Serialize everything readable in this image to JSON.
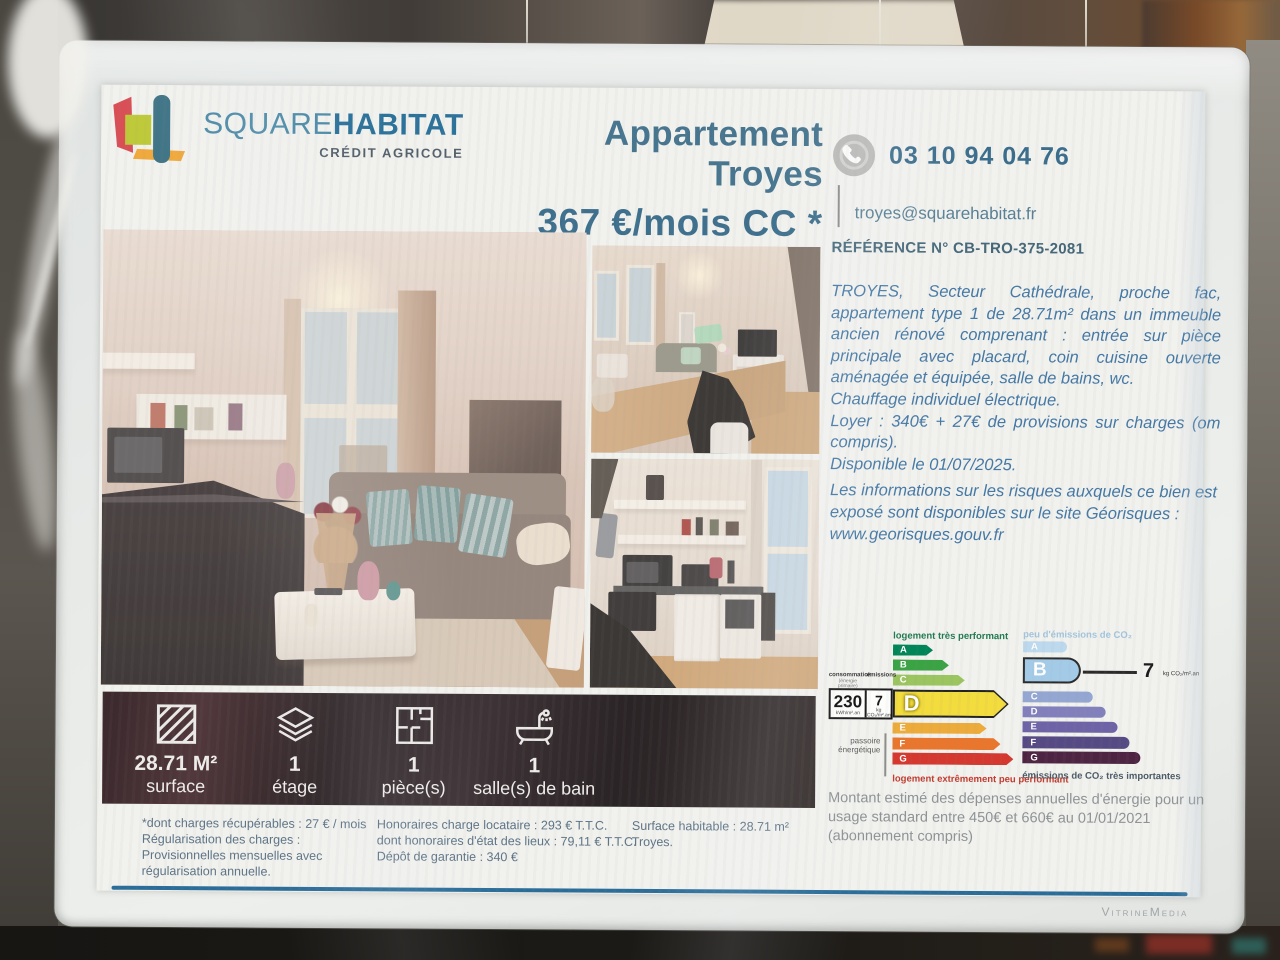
{
  "scene": {
    "watermark": "VitrineMedia"
  },
  "brand": {
    "name_1": "SQUARE",
    "name_2": "HABITAT",
    "subtitle": "CRÉDIT AGRICOLE"
  },
  "listing": {
    "property_type": "Appartement",
    "city": "Troyes",
    "price": "367 €/mois CC *",
    "phone": "03 10 94 04 76",
    "email": "troyes@squarehabitat.fr",
    "reference": "RÉFÉRENCE N° CB-TRO-375-2081"
  },
  "description": [
    "TROYES, Secteur Cathédrale, proche fac, appartement type 1 de 28.71m² dans un immeuble ancien rénové comprenant : entrée sur pièce principale avec placard, coin cuisine ouverte aménagée et équipée, salle de bains, wc.",
    "Chauffage individuel électrique.",
    "Loyer : 340€ + 27€ de provisions sur charges (om compris).",
    "Disponible le 01/07/2025.",
    "Les informations sur les risques auxquels ce bien est exposé sont disponibles sur le site Géorisques :",
    "www.georisques.gouv.fr"
  ],
  "features": [
    {
      "icon": "surface-hatch-icon",
      "value": "28.71 M²",
      "label": "surface"
    },
    {
      "icon": "floors-stack-icon",
      "value": "1",
      "label": "étage"
    },
    {
      "icon": "floorplan-icon",
      "value": "1",
      "label": "pièce(s)"
    },
    {
      "icon": "bathtub-icon",
      "value": "1",
      "label": "salle(s) de bain"
    }
  ],
  "footnotes": {
    "charges": [
      "*dont charges récupérables : 27 € / mois",
      "Régularisation des charges :",
      "Provisionnelles mensuelles avec",
      "régularisation annuelle."
    ],
    "fees": [
      "Honoraires charge locataire : 293 € T.T.C.",
      "dont honoraires d'état des lieux : 79,11 € T.T.C.",
      "Dépôt de garantie : 340 €"
    ],
    "surface": [
      "Surface habitable : 28.71 m²",
      "Troyes."
    ]
  },
  "chart_data": [
    {
      "type": "bar",
      "name": "DPE énergie",
      "label_top": "logement très performant",
      "label_bottom": "logement extrêmement peu performant",
      "classes": [
        "A",
        "B",
        "C",
        "D",
        "E",
        "F",
        "G"
      ],
      "colors": [
        "#008558",
        "#3aa344",
        "#9bc55f",
        "#f2dc3e",
        "#edab3a",
        "#e9762c",
        "#d4382e"
      ],
      "rating": "D",
      "consumption": {
        "header": "consommation",
        "subheader": "(énergie primaire)",
        "value": "230",
        "unit": "kWh/m².an"
      },
      "emissions": {
        "header": "émissions",
        "value": "7",
        "unit": "kg CO₂/m².an"
      },
      "side_label": "passoire énergétique"
    },
    {
      "type": "bar",
      "name": "DPE CO₂",
      "label_top": "peu d'émissions de CO₂",
      "label_bottom": "émissions de CO₂ très importantes",
      "classes": [
        "A",
        "B",
        "C",
        "D",
        "E",
        "F",
        "G"
      ],
      "colors": [
        "#bdd9ee",
        "#a3cbe8",
        "#94a7d2",
        "#8280bc",
        "#6d63a6",
        "#564a84",
        "#4e2443"
      ],
      "rating": "B",
      "value": "7",
      "unit": "kg CO₂/m².an"
    }
  ],
  "energy_note": "Montant estimé des dépenses annuelles d'énergie pour un usage standard entre 450€ et 660€ au 01/01/2021 (abonnement compris)"
}
